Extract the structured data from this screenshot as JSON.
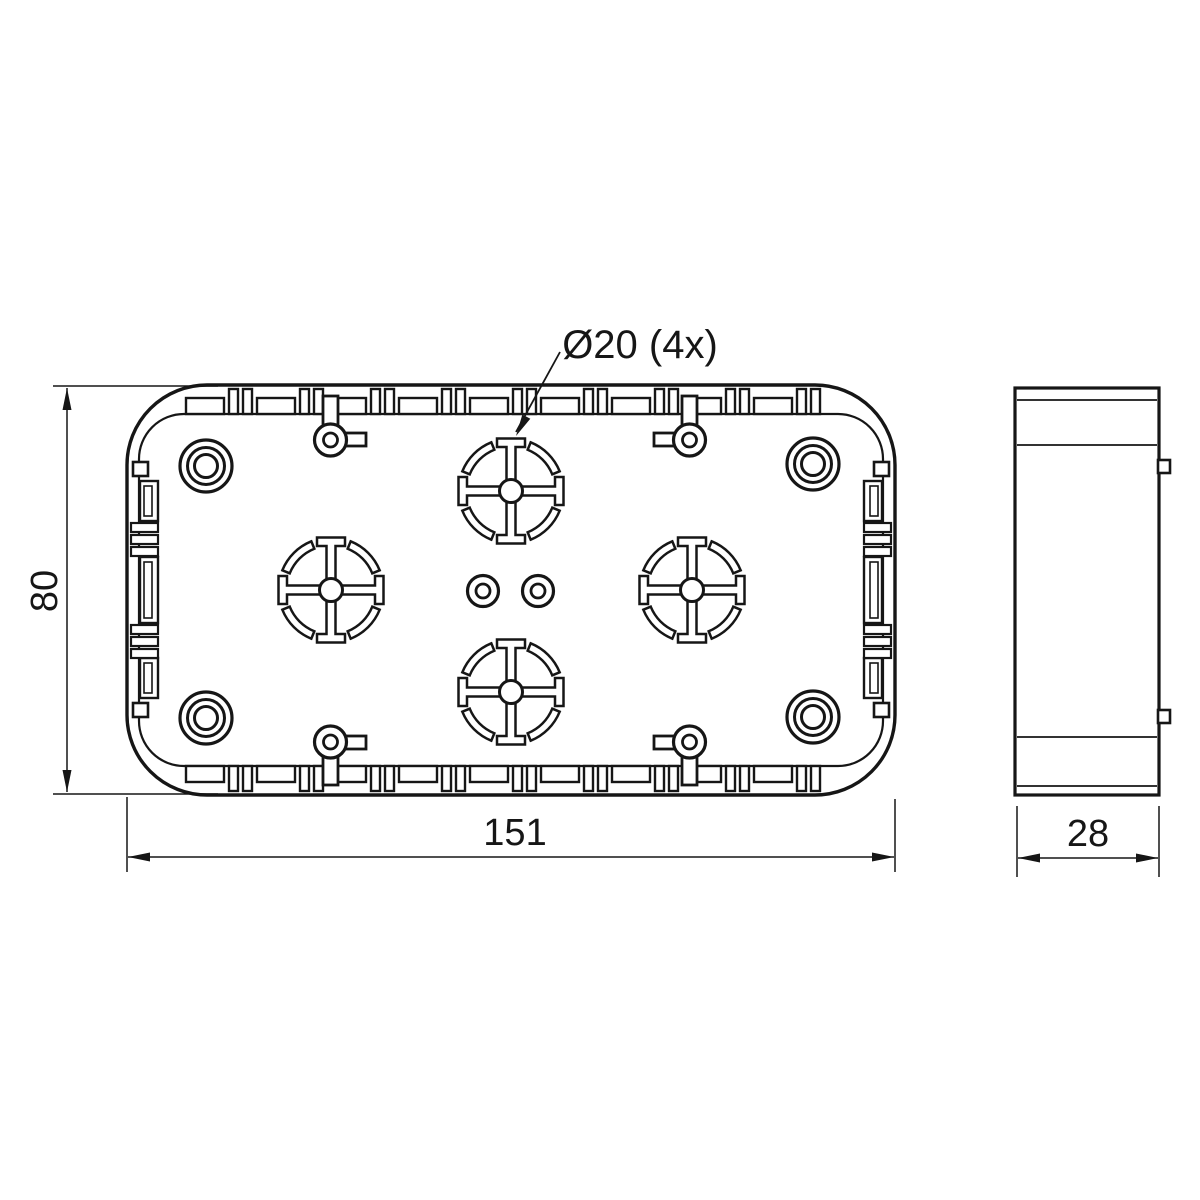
{
  "callout": {
    "label": "Ø20 (4x)"
  },
  "dimensions": {
    "height": {
      "value": "80"
    },
    "width": {
      "value": "151"
    },
    "depth": {
      "value": "28"
    }
  },
  "colors": {
    "line": "#161616",
    "background": "#ffffff"
  }
}
